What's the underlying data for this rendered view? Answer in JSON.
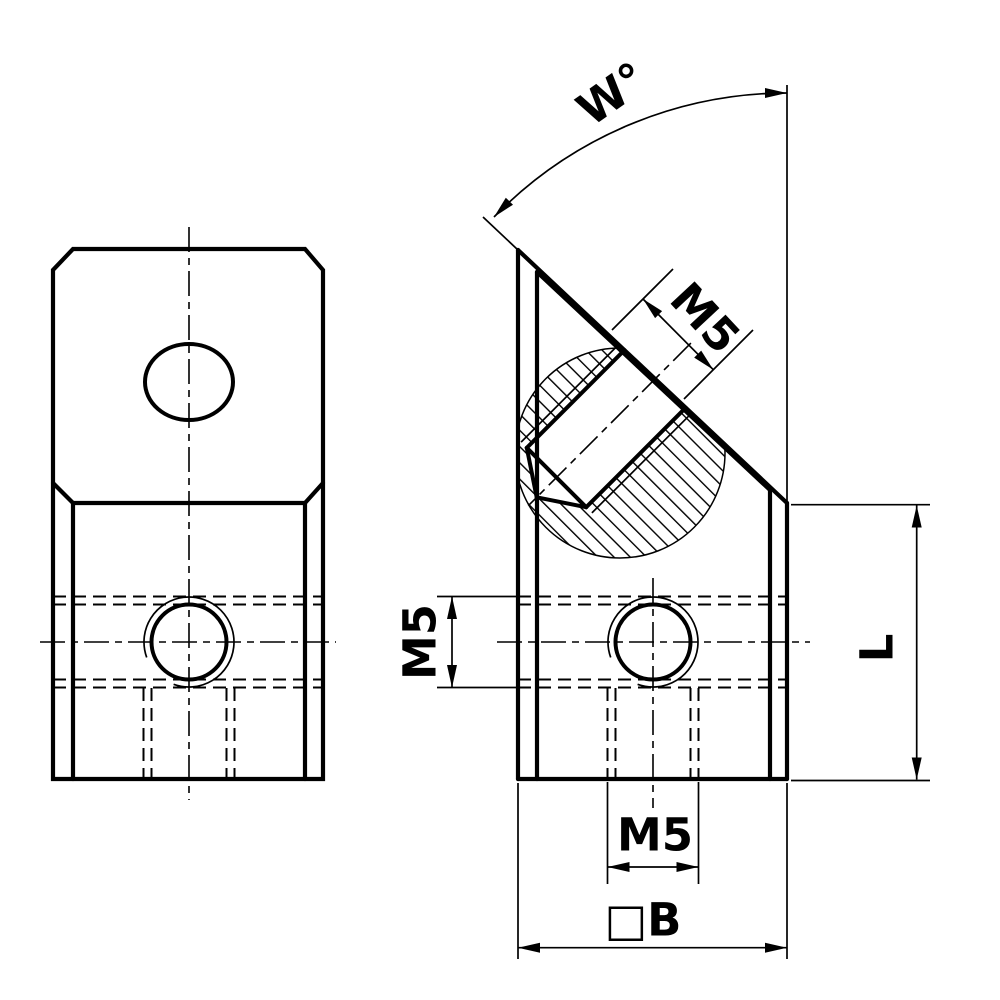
{
  "drawing": {
    "background": "#ffffff",
    "line_color": "#000000",
    "labels": {
      "angle": "W°",
      "thread_angled": "M5",
      "thread_side": "M5",
      "thread_bottom": "M5",
      "length": "L",
      "width": "□B"
    }
  }
}
